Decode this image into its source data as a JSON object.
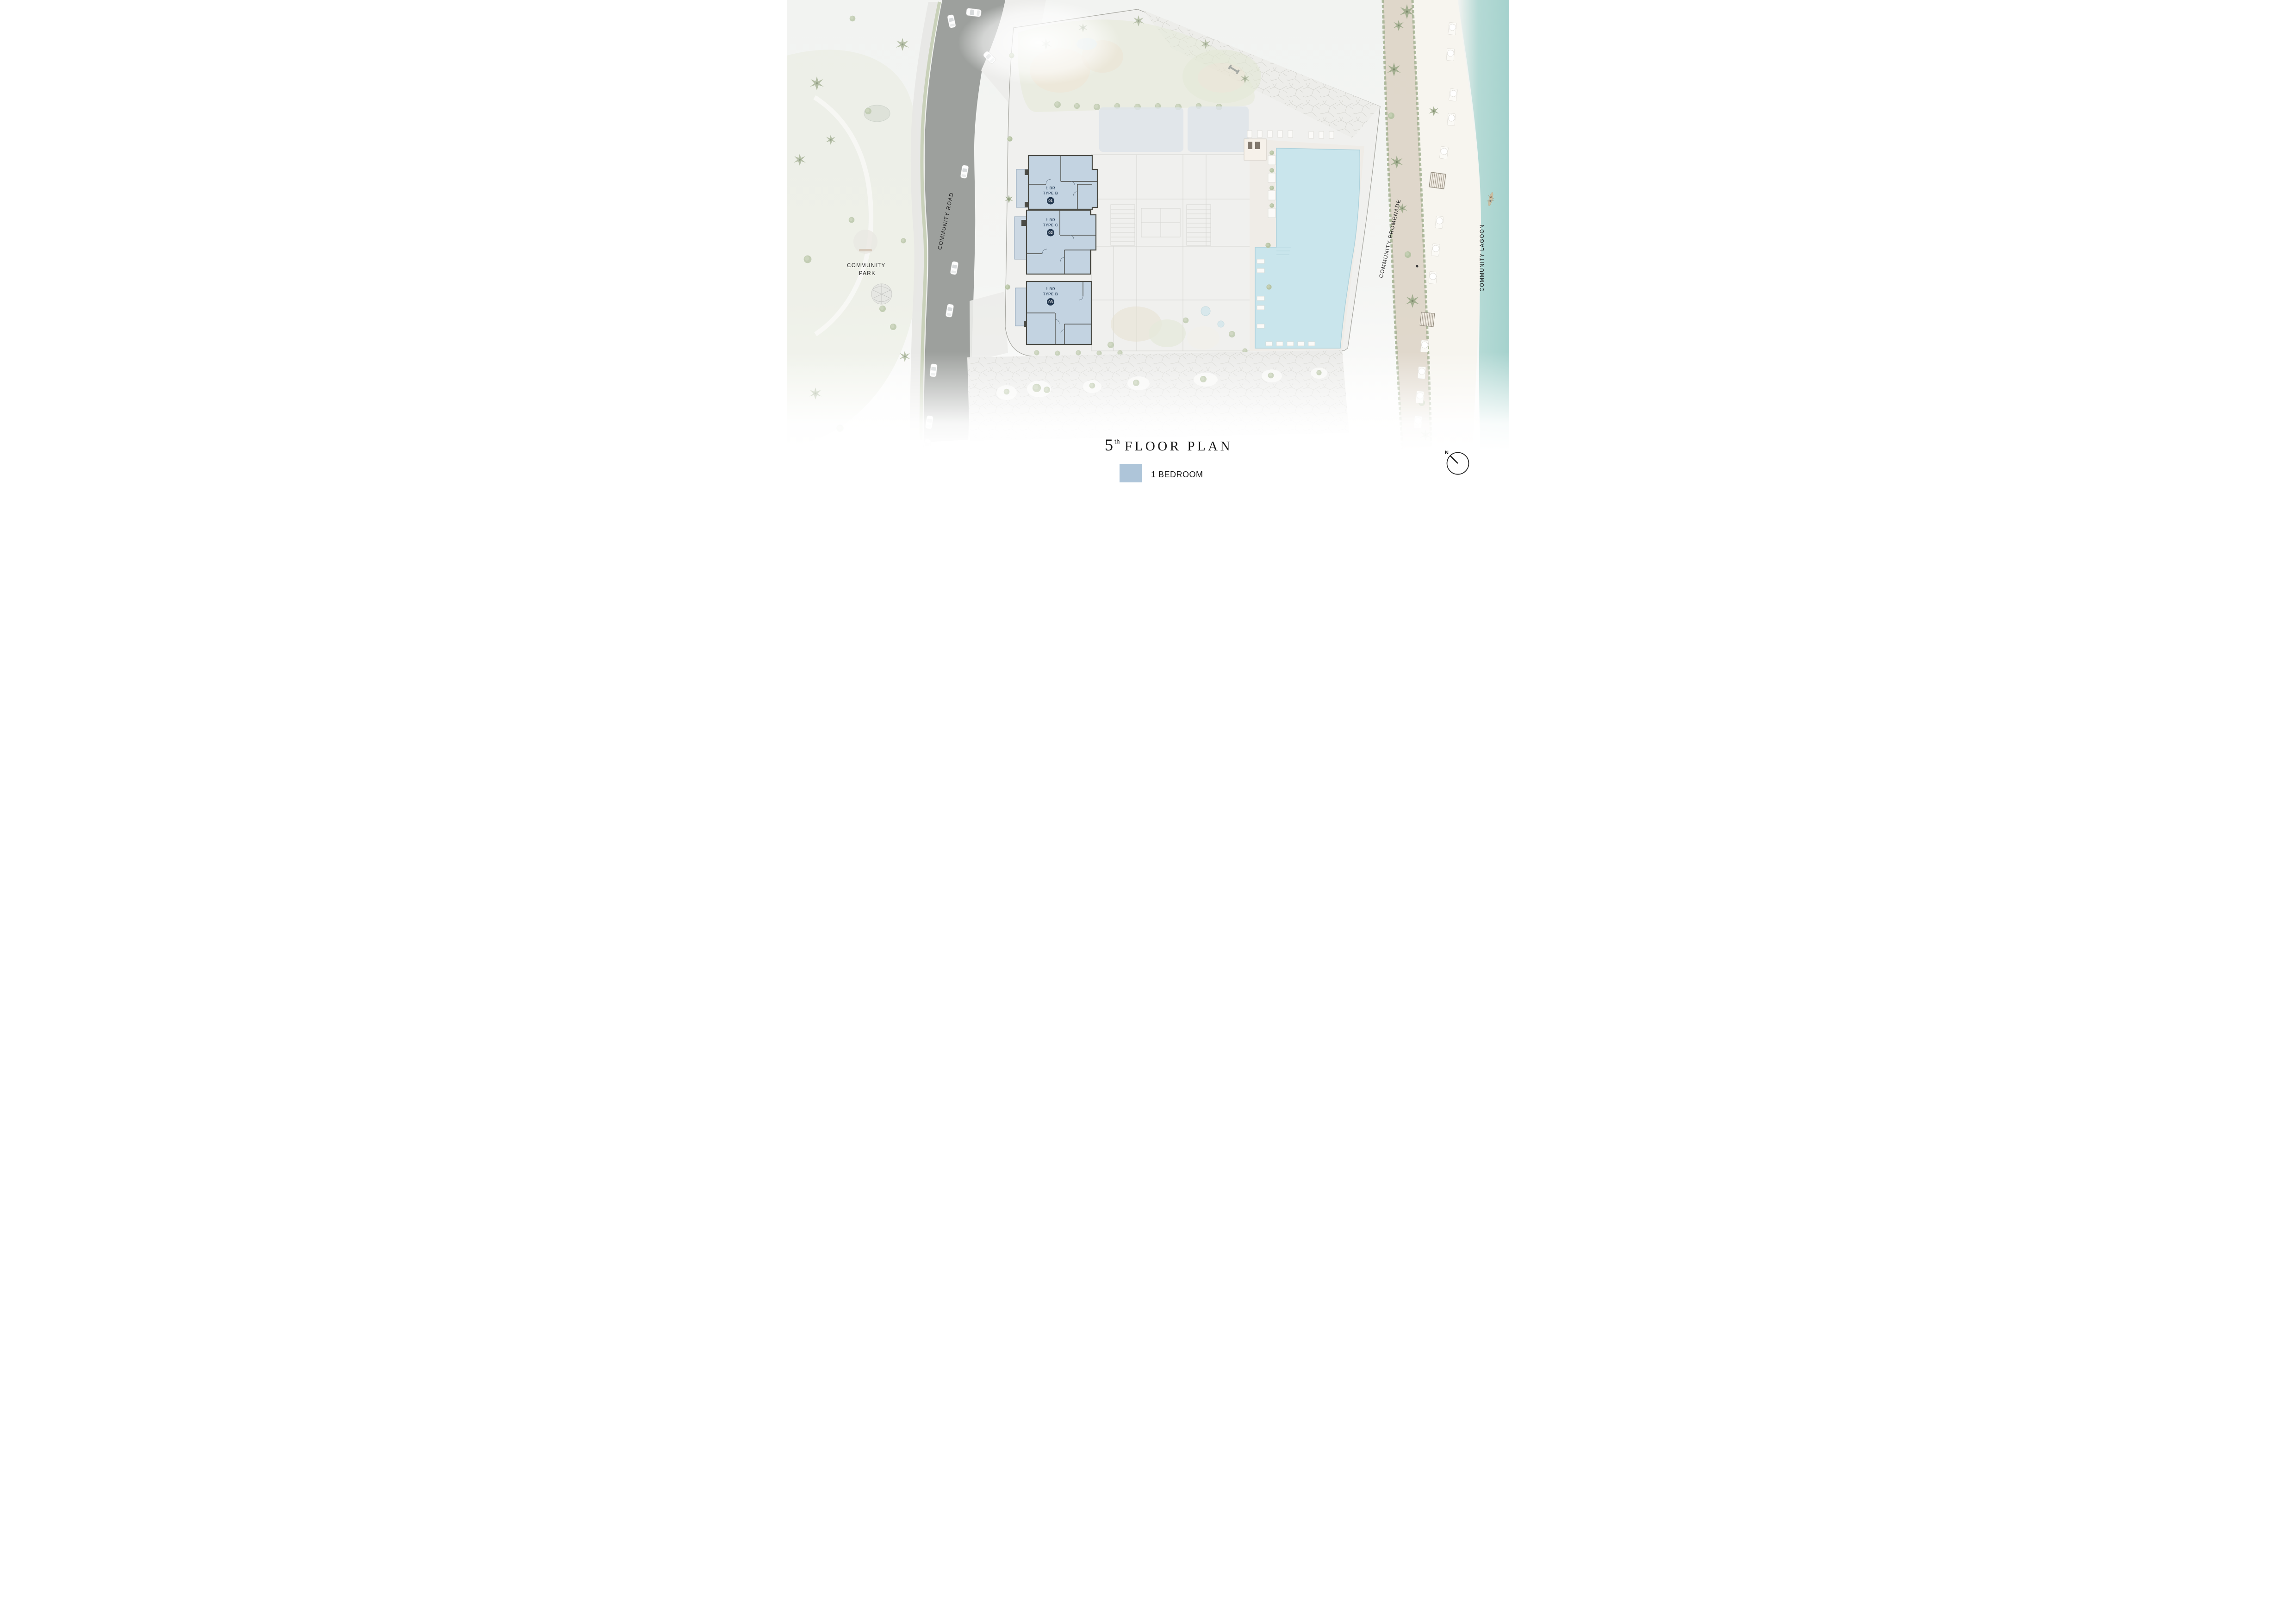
{
  "title": {
    "floor_number": "5",
    "ordinal_suffix": "th",
    "label": "FLOOR PLAN"
  },
  "legend": {
    "items": [
      {
        "label": "1 BEDROOM",
        "color": "#aec5d9"
      }
    ]
  },
  "map": {
    "area_labels": {
      "community_park_line1": "COMMUNITY",
      "community_park_line2": "PARK",
      "community_road": "COMMUNITY ROAD",
      "community_promenade": "COMMUNITY PROMENADE",
      "community_lagoon": "COMMUNITY LAGOON"
    },
    "units": [
      {
        "name": "1 BR",
        "type": "TYPE B",
        "number": "01"
      },
      {
        "name": "1 BR",
        "type": "TYPE C",
        "number": "02"
      },
      {
        "name": "1 BR",
        "type": "TYPE B",
        "number": "03"
      }
    ],
    "compass": {
      "north_label": "N"
    }
  },
  "colors": {
    "unit_fill": "#c3d3e1",
    "unit_badge": "#24384f",
    "unit_text": "#2f4660",
    "pool": "#c9e5ec",
    "lagoon": "#aed7d2",
    "road": "#9da09d",
    "legend_swatch": "#aec5d9"
  }
}
